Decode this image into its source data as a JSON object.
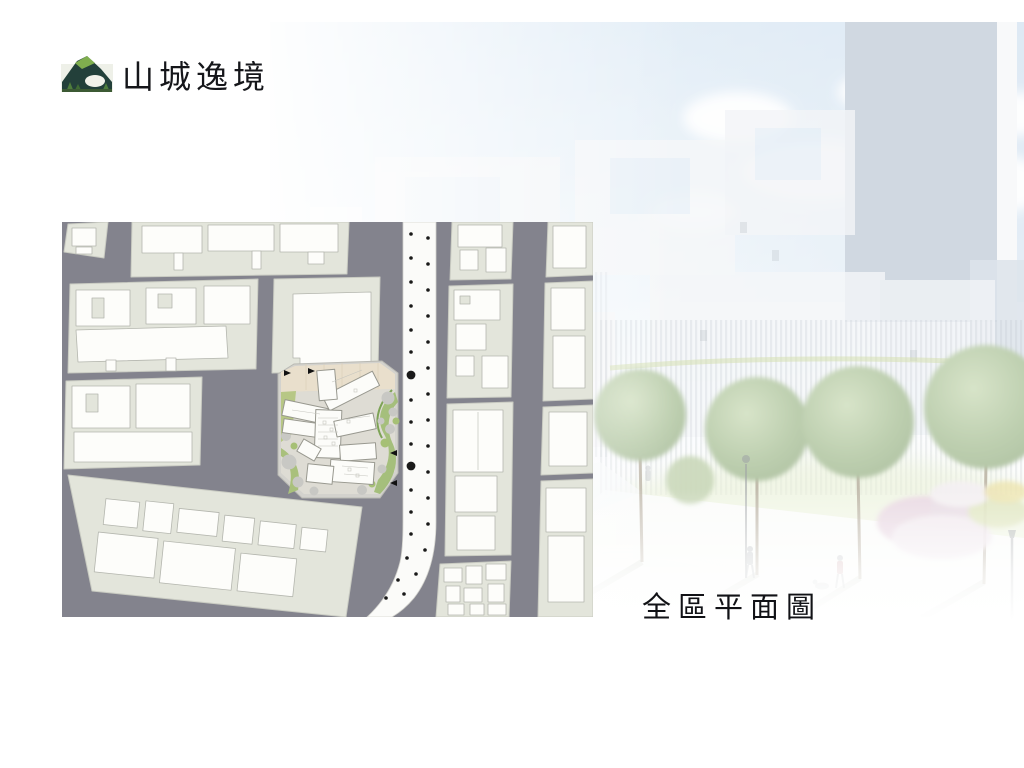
{
  "logo": {
    "icon": "mountain-logo-icon",
    "text": "山城逸境"
  },
  "caption": {
    "text": "全區平面圖"
  },
  "site_plan": {
    "colors": {
      "road": "#83838D",
      "block": "#E3E5DB",
      "building": "#FDFDFA",
      "building_outline": "#B4B6AE",
      "street": "#FBFBF9",
      "street_dot": "#1A1A1A",
      "site_ground_tan": "#E9DFCC",
      "landscape_green": "#9FBB72",
      "tree_marker_gray": "#C8C8C4"
    }
  },
  "rendering": {
    "colors": {
      "sky": "#CFE1F1",
      "tower": "#B1BECD",
      "tree_green": "#93B07C",
      "bush_pink": "#DCBFD2",
      "lawn_green": "#DCE8BC"
    }
  }
}
